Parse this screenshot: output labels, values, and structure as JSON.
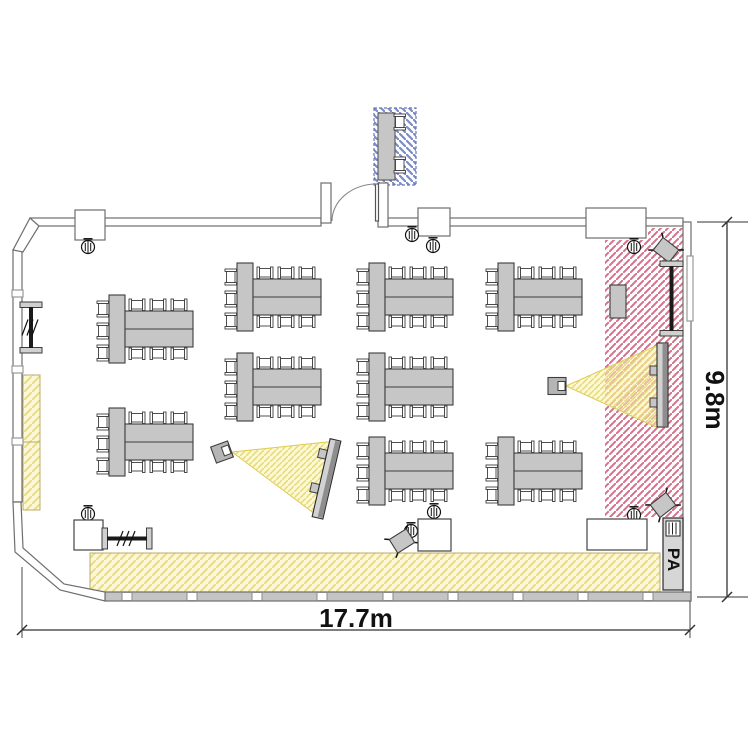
{
  "labels": {
    "width_dim": "17.7m",
    "height_dim": "9.8m",
    "pa_label": "PA"
  },
  "colors": {
    "wall_stroke": "#6e6e6e",
    "bottom_wall_fill": "#c4c4c4",
    "table_fill": "#c6c6c6",
    "furniture_stroke": "#3d3d3d",
    "chair_fill": "#ffffff",
    "yellow_zone_bg": "#fbf7da",
    "yellow_zone_stripe": "#e8dc88",
    "red_zone_stripe": "#d4728c",
    "blue_zone_stripe": "#7d8cc8",
    "beam_fill": "#faf3b4",
    "beam_stripe": "#e8d96a",
    "screen_fill": "#d2d2d2",
    "screen_dark": "#8e8e8e",
    "dim_color": "#111111"
  },
  "plan": {
    "table_groups": [
      {
        "x": 97,
        "y": 295
      },
      {
        "x": 97,
        "y": 408
      },
      {
        "x": 225,
        "y": 263
      },
      {
        "x": 225,
        "y": 353
      },
      {
        "x": 357,
        "y": 263
      },
      {
        "x": 357,
        "y": 353
      },
      {
        "x": 357,
        "y": 437
      },
      {
        "x": 486,
        "y": 263
      },
      {
        "x": 486,
        "y": 437
      }
    ],
    "speakers": [
      [
        88,
        247
      ],
      [
        412,
        235
      ],
      [
        433,
        246
      ],
      [
        634,
        247
      ],
      [
        88,
        514
      ],
      [
        434,
        512
      ],
      [
        634,
        515
      ],
      [
        411,
        531
      ]
    ],
    "tilted_chairs": [
      {
        "cx": 666,
        "cy": 250,
        "rot": 38
      },
      {
        "cx": 663,
        "cy": 505,
        "rot": -38
      },
      {
        "cx": 402,
        "cy": 541,
        "rot": -32
      }
    ],
    "square_tables": [
      [
        74,
        520,
        29,
        30
      ],
      [
        418,
        519,
        33,
        32
      ],
      [
        587,
        519,
        60,
        31
      ]
    ],
    "racks": [
      {
        "type": "v",
        "x": 20,
        "y1": 302,
        "y2": 353,
        "w": 22,
        "slashes": true
      },
      {
        "type": "h",
        "y": 528,
        "x1": 102,
        "x2": 152,
        "h": 21,
        "slashes": true
      },
      {
        "type": "v",
        "x": 660,
        "y1": 261,
        "y2": 336,
        "w": 23,
        "slashes": false
      }
    ],
    "lectern": [
      610,
      285,
      16,
      33
    ],
    "projectors": [
      {
        "cx": 222,
        "cy": 452,
        "rot": -20
      },
      {
        "cx": 557,
        "cy": 386,
        "rot": 0
      }
    ],
    "screens": {
      "right": {
        "x": 657,
        "y": 343,
        "w": 11,
        "h": 84,
        "tabs_y": [
          366,
          398
        ]
      },
      "tilted": {
        "cx": 327,
        "cy": 479,
        "w": 11,
        "h": 80,
        "rot": 13,
        "tabs_y": [
          451,
          486
        ]
      }
    },
    "registration": {
      "table": [
        378,
        113,
        17,
        67
      ],
      "chairs": [
        [
          394,
          114
        ],
        [
          394,
          157
        ]
      ]
    },
    "pa_box": [
      663,
      518,
      20,
      72
    ],
    "mullions_x": [
      122,
      187,
      252,
      317,
      383,
      448,
      513,
      578,
      643
    ]
  }
}
